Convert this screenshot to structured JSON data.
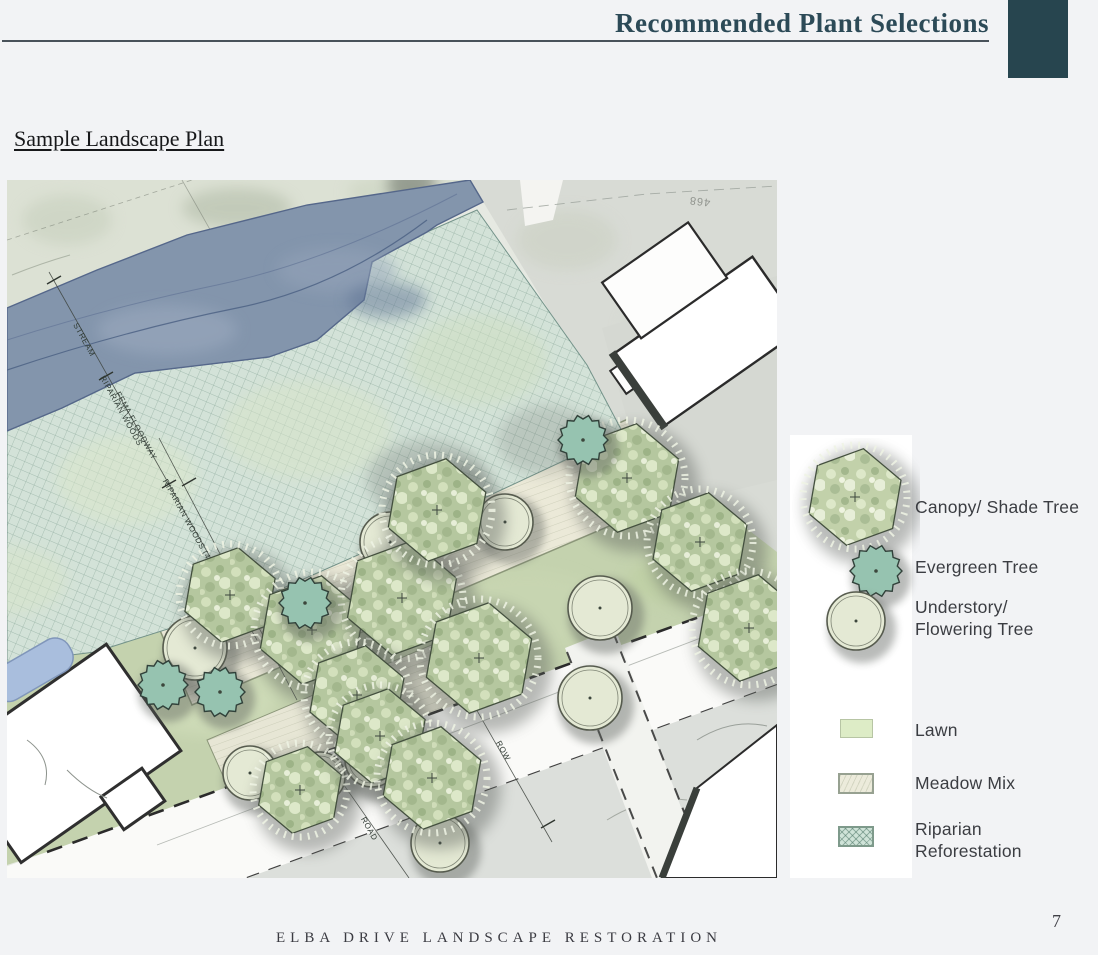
{
  "header": {
    "title": "Recommended Plant Selections"
  },
  "section": {
    "title": "Sample Landscape Plan"
  },
  "plan": {
    "labels": {
      "stream": "STREAM",
      "riparian_woods": "RIPARIAN WOODS",
      "fema_floodway": "FEMA FLOODWAY",
      "riparian_woods_40": "RIPARIAN WOODS (40')",
      "row": "ROW",
      "road": "ROAD",
      "contour": "468"
    }
  },
  "legend": {
    "items": [
      {
        "label": "Canopy/ Shade Tree",
        "symbol": "canopy-tree"
      },
      {
        "label": "Evergreen Tree",
        "symbol": "evergreen-tree"
      },
      {
        "label": "Understory/\nFlowering Tree",
        "symbol": "understory-tree"
      },
      {
        "label": "Lawn",
        "symbol": "lawn-swatch"
      },
      {
        "label": "Meadow Mix",
        "symbol": "meadow-swatch"
      },
      {
        "label": "Riparian\nReforestation",
        "symbol": "riparian-swatch"
      }
    ]
  },
  "footer": {
    "title": "ELBA DRIVE LANDSCAPE RESTORATION",
    "page_number": "7"
  },
  "colors": {
    "accent_teal": "#27454f",
    "title_teal": "#2c4a57",
    "stream_blue": "#8395ac",
    "riparian_green": "#d3e2d8",
    "lawn_green": "#c4d2ae",
    "meadow_cream": "#ebe9d8",
    "evergreen_teal": "#96c3b0"
  }
}
